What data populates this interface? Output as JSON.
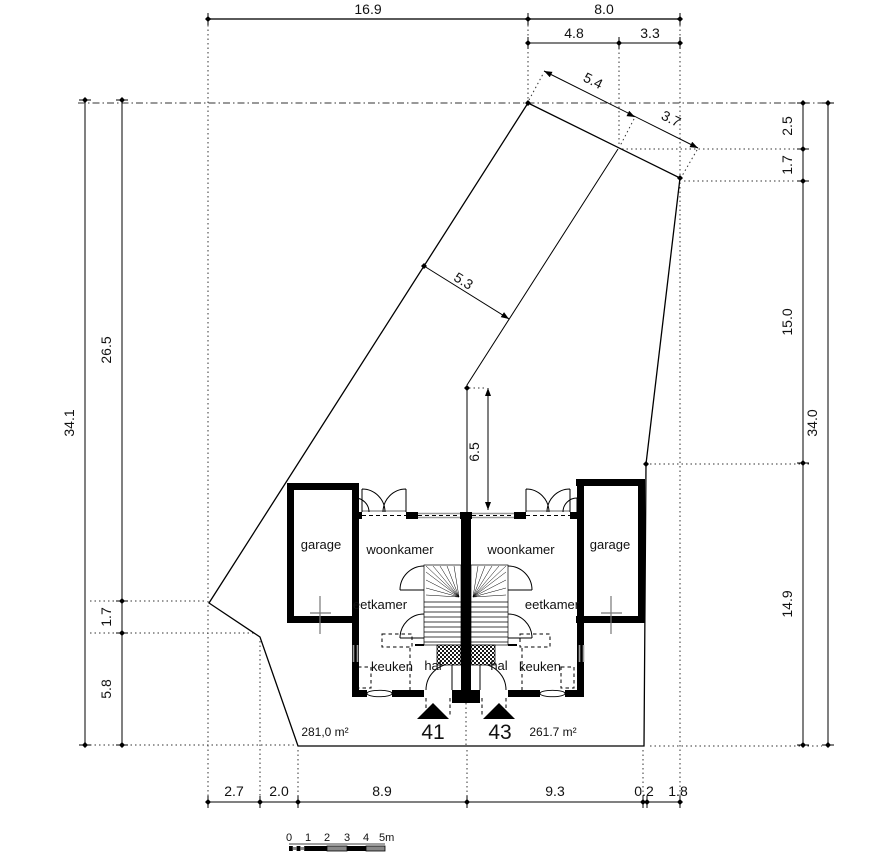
{
  "dimensions": {
    "top_row1": [
      "16.9",
      "8.0"
    ],
    "top_row2": [
      "4.8",
      "3.3"
    ],
    "edge_top_right": [
      "5.4",
      "3.7"
    ],
    "parcel_width": "5.3",
    "front_depth": "6.5",
    "left_outer": "34.1",
    "left_inner": [
      "26.5",
      "1.7",
      "5.8"
    ],
    "right_inner": [
      "2.5",
      "1.7",
      "15.0",
      "14.9"
    ],
    "right_outer": "34.0",
    "bottom": [
      "2.7",
      "2.0",
      "8.9",
      "9.3",
      "0.2",
      "1.8"
    ]
  },
  "houses": [
    {
      "number": "41",
      "area": "281,0 m²",
      "garage": "garage",
      "living_room": "woonkamer",
      "dining_room": "eetkamer",
      "kitchen": "keuken",
      "hall": "hal"
    },
    {
      "number": "43",
      "area": "261.7 m²",
      "garage": "garage",
      "living_room": "woonkamer",
      "dining_room": "eetkamer",
      "kitchen": "keuken",
      "hall": "hal"
    }
  ],
  "scale_bar": {
    "ticks": [
      "0",
      "1",
      "2",
      "3",
      "4"
    ],
    "unit_label": "5m"
  }
}
